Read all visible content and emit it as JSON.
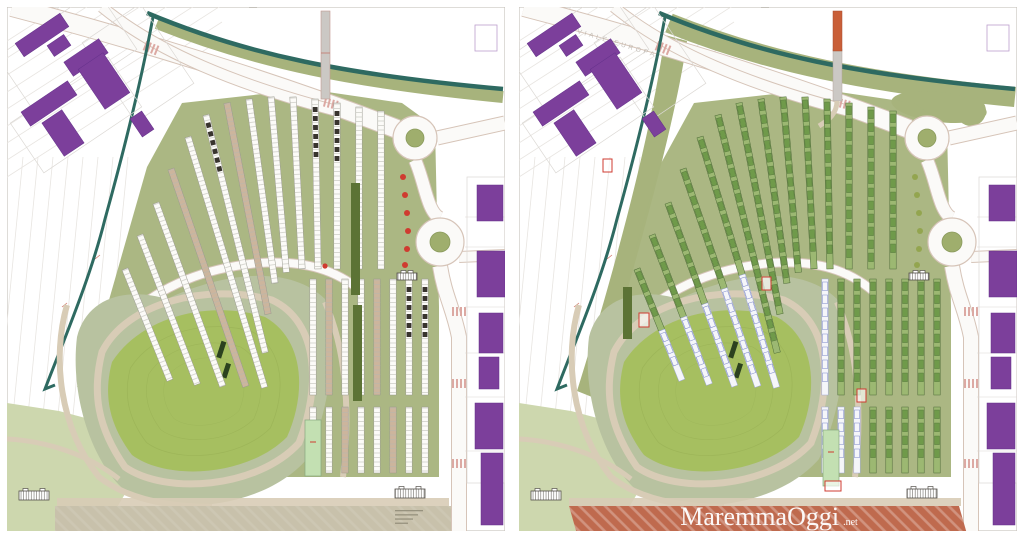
{
  "page": {
    "title": "Confronto planimetrie area mercato",
    "background": "#ffffff"
  },
  "panels": [
    {
      "id": "left",
      "name": "site-plan-left"
    },
    {
      "id": "right",
      "name": "site-plan-right"
    }
  ],
  "watermark": {
    "text": "MaremmaOggi",
    "suffix": ".net"
  },
  "street_label": "VIALE EUROPA",
  "icons": [
    {
      "name": "roundabout-icon"
    },
    {
      "name": "canal-line-icon"
    },
    {
      "name": "footbridge-icon"
    },
    {
      "name": "building-footprint-icon"
    },
    {
      "name": "tree-dot-icon"
    }
  ],
  "colors": {
    "purple": "#7c3f9b",
    "purple_dark": "#63318a",
    "canal": "#2e6a61",
    "olive": "#a7b37c",
    "olive_dark": "#5c7335",
    "hill": "#a6bf60",
    "hill_ring": "#b8c2a0",
    "hill_contour": "#95ad52",
    "pale_green": "#cdd7ae",
    "mint": "#c3e0b2",
    "path": "#d8ccb6",
    "road_edge": "#d6c4b8",
    "road_fill": "#fbfaf8",
    "pink_hatch": "#dca9a3",
    "tan": "#ccb59d",
    "row_outline": "#9a9a90",
    "dark_car": "#38342e",
    "green_row": "#9cb872",
    "green_row_dark": "#6f9a4a",
    "green_row_stroke": "#4c6a36",
    "blue_row": "#7b86c8",
    "red": "#cf3b30",
    "orange": "#c95f38",
    "dot_right": "#93a54f",
    "terracotta": "#bf6a4e",
    "strip_beige": "#c8c1ab",
    "frame": "#c9c4bd",
    "faint": "#e8e5e1",
    "gray_bridge": "#cbc8c4",
    "dark_tree": "#2c421f"
  }
}
